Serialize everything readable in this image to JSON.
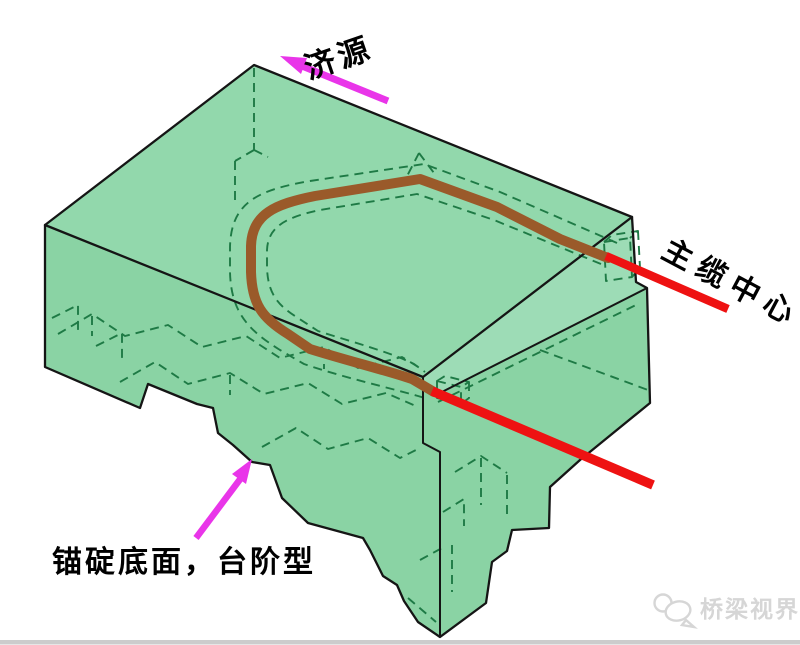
{
  "diagram": {
    "labels": {
      "direction": "济源",
      "cable_center": "主缆中心",
      "anchor_base": "锚碇底面，台阶型"
    },
    "watermark": {
      "text": "桥梁视界"
    }
  },
  "colors": {
    "background": "#ffffff",
    "block_fill": "#8ad3a4",
    "block_top_fill": "#92d8ac",
    "block_band_fill": "#9ddcb6",
    "edge": "#151515",
    "hidden_edge": "#1e7a45",
    "cable": "#9a5a2a",
    "cable_center_line": "#ee1212",
    "arrow": "#e935e9",
    "label_text": "#000000",
    "watermark_gray": "#d6d6d6",
    "footer_line": "#cccccc"
  }
}
